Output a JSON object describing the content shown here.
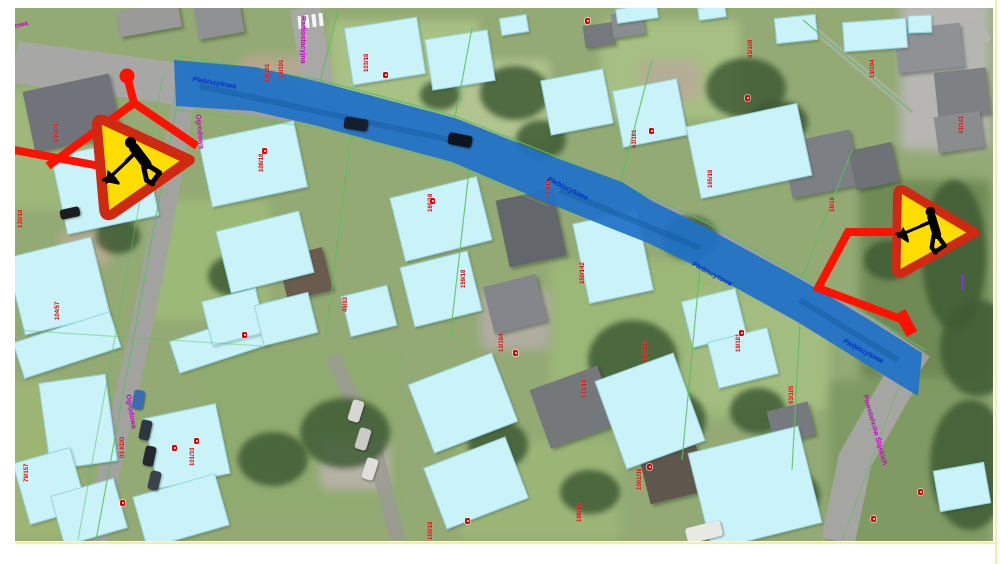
{
  "map": {
    "description": "aerial orthophoto with GIS road-closure overlay and roadworks signs",
    "road_overlay_street": "Plebiscytowa",
    "street_labels_blue": [
      {
        "text": "Plebiscytowa",
        "x": 193,
        "y": 76,
        "rot": 10
      },
      {
        "text": "Plebiscytowa",
        "x": 549,
        "y": 176,
        "rot": 26
      },
      {
        "text": "Plebiscytowa",
        "x": 694,
        "y": 261,
        "rot": 28
      },
      {
        "text": "Plebiscytowa",
        "x": 845,
        "y": 338,
        "rot": 28
      }
    ],
    "street_labels_magenta": [
      {
        "text": "Plebiscytowa",
        "x": -16,
        "y": 30,
        "rot": -13
      },
      {
        "text": "Radiostacyjna",
        "x": 306,
        "y": 16,
        "rot": 90
      },
      {
        "text": "Ogrodowa",
        "x": 201,
        "y": 114,
        "rot": 84
      },
      {
        "text": "Ogrodowa",
        "x": 131,
        "y": 394,
        "rot": 80
      },
      {
        "text": "Powstańców Śląskich",
        "x": 868,
        "y": 394,
        "rot": 74
      }
    ],
    "parcel_labels": [
      {
        "text": "19/191",
        "x": 265,
        "y": 82
      },
      {
        "text": "18/191",
        "x": 279,
        "y": 78
      },
      {
        "text": "103/18",
        "x": 364,
        "y": 72
      },
      {
        "text": "19/103",
        "x": 54,
        "y": 142
      },
      {
        "text": "130/18",
        "x": 18,
        "y": 228
      },
      {
        "text": "108/18",
        "x": 259,
        "y": 172
      },
      {
        "text": "02 KDL",
        "x": 546,
        "y": 198
      },
      {
        "text": "160/18",
        "x": 428,
        "y": 212
      },
      {
        "text": "159/18",
        "x": 461,
        "y": 288
      },
      {
        "text": "13/184",
        "x": 499,
        "y": 352
      },
      {
        "text": "150/142",
        "x": 580,
        "y": 284
      },
      {
        "text": "170/183",
        "x": 643,
        "y": 362
      },
      {
        "text": "133/18",
        "x": 582,
        "y": 398
      },
      {
        "text": "19/181",
        "x": 736,
        "y": 352
      },
      {
        "text": "63/181",
        "x": 632,
        "y": 148
      },
      {
        "text": "165/18",
        "x": 708,
        "y": 188
      },
      {
        "text": "18/19",
        "x": 830,
        "y": 212
      },
      {
        "text": "101/19",
        "x": 908,
        "y": 262
      },
      {
        "text": "43/141",
        "x": 959,
        "y": 134
      },
      {
        "text": "63/108",
        "x": 748,
        "y": 58
      },
      {
        "text": "104/57",
        "x": 55,
        "y": 320
      },
      {
        "text": "79/157",
        "x": 24,
        "y": 482
      },
      {
        "text": "101/33",
        "x": 190,
        "y": 466
      },
      {
        "text": "03 KDD",
        "x": 120,
        "y": 458
      },
      {
        "text": "46/93",
        "x": 343,
        "y": 312
      },
      {
        "text": "198/18",
        "x": 577,
        "y": 522
      },
      {
        "text": "19/194",
        "x": 870,
        "y": 78
      },
      {
        "text": "63/105",
        "x": 789,
        "y": 404
      },
      {
        "text": "150/18",
        "x": 428,
        "y": 540
      },
      {
        "text": "1001/38",
        "x": 637,
        "y": 490
      }
    ],
    "markers": [
      {
        "x": 383,
        "y": 72
      },
      {
        "x": 262,
        "y": 148
      },
      {
        "x": 430,
        "y": 198
      },
      {
        "x": 513,
        "y": 350
      },
      {
        "x": 739,
        "y": 330
      },
      {
        "x": 649,
        "y": 128
      },
      {
        "x": 745,
        "y": 95
      },
      {
        "x": 120,
        "y": 500
      },
      {
        "x": 242,
        "y": 332
      },
      {
        "x": 871,
        "y": 516
      },
      {
        "x": 647,
        "y": 464
      },
      {
        "x": 194,
        "y": 438
      },
      {
        "x": 465,
        "y": 518
      },
      {
        "x": 918,
        "y": 489
      },
      {
        "x": 585,
        "y": 18
      },
      {
        "x": 172,
        "y": 445
      }
    ],
    "signs": [
      {
        "name": "roadworks-sign-left",
        "meaning": "road works warning (digging worker)"
      },
      {
        "name": "roadworks-sign-right",
        "meaning": "road works warning (digging worker)"
      }
    ],
    "colors": {
      "closure_overlay": "#1f72c7",
      "highlighted_building": "#c9f3f9",
      "sign_fill": "#ffdd00",
      "sign_border": "#d02912",
      "arrow_red": "#ff1200",
      "parcel_label_red": "#dd0000",
      "street_label_magenta": "#cc00cc",
      "street_label_blue": "#0030c0",
      "cadastral_line_green": "#5bc05b"
    }
  }
}
